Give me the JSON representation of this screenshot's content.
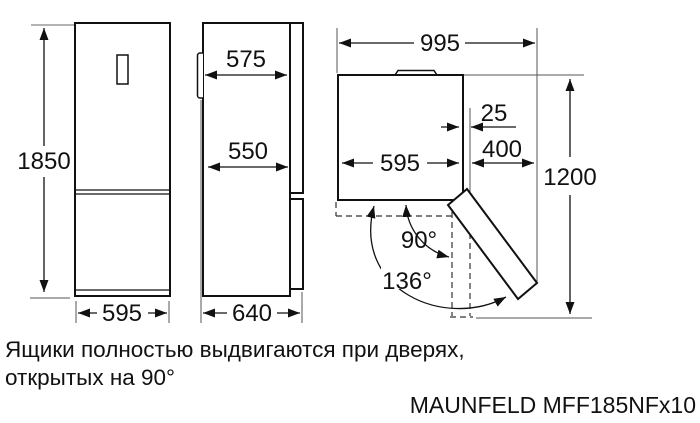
{
  "labels": {
    "front": {
      "height": "1850",
      "width": "595"
    },
    "side": {
      "door_depth": "575",
      "body_depth": "550",
      "total_depth": "640"
    },
    "top": {
      "total_width": "995",
      "width": "595",
      "side_gap": "25",
      "door_clearance": "400",
      "required_depth": "1200",
      "angle_90": "90°",
      "angle_136": "136°"
    }
  },
  "footer": {
    "note_line1": "Ящики полностью выдвигаются при дверях,",
    "note_line2": "открытых на 90°",
    "model": "MAUNFELD MFF185NFx10"
  },
  "colors": {
    "line": "#111111",
    "background": "#ffffff"
  }
}
